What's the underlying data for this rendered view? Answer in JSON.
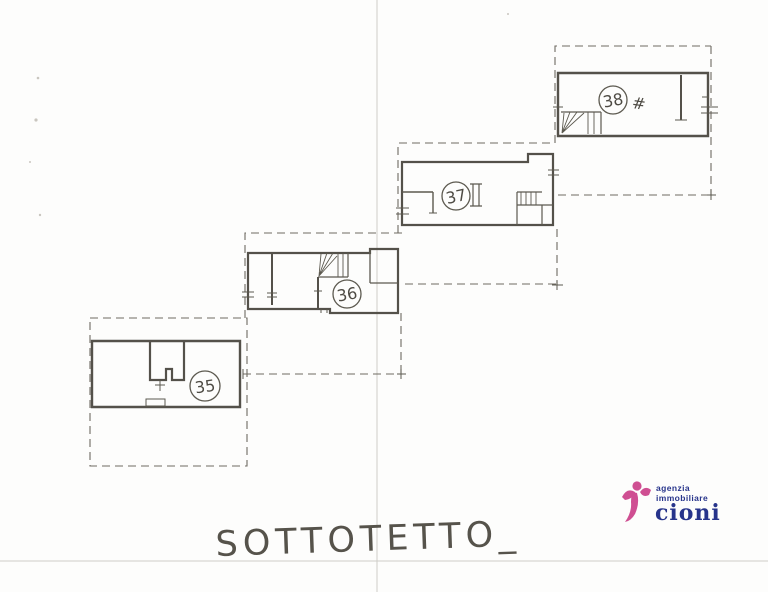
{
  "page": {
    "title": "SOTTOTETTO_",
    "floor_label": "attic floor plan"
  },
  "units": [
    {
      "number": "35"
    },
    {
      "number": "36"
    },
    {
      "number": "37"
    },
    {
      "number": "38",
      "annotation": "#"
    }
  ],
  "logo": {
    "line1": "agenzia",
    "line2": "immobiliare",
    "name": "cioni",
    "colors": {
      "pink": "#cf4f92",
      "navy": "#27348b"
    }
  },
  "drawing": {
    "line_color": "#54514a",
    "dash_color": "#6e6a62"
  }
}
